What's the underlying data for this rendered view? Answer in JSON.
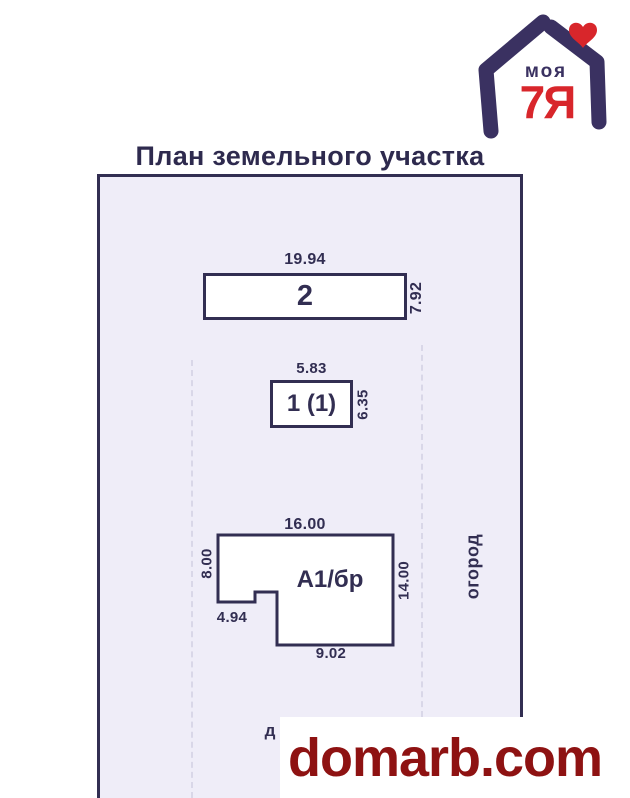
{
  "logo": {
    "top_text": "моя",
    "main_text": "7Я",
    "heart_icon": "heart"
  },
  "title": "План земельного участка",
  "buildings": {
    "b2": {
      "label": "2",
      "top_dim": "19.94",
      "side_dim": "7.92"
    },
    "b1": {
      "label": "1 (1)",
      "top_dim": "5.83",
      "side_dim": "6.35"
    },
    "a1": {
      "label": "А1/бр",
      "top_dim": "16.00",
      "left_dim": "8.00",
      "right_dim": "14.00",
      "notch_dim": "4.94",
      "bottom_dim": "9.02"
    }
  },
  "zones": {
    "garden": "огород",
    "road_partial": "д"
  },
  "watermark": {
    "text": "domarb.com"
  },
  "colors": {
    "ink": "#322e52",
    "plot_fill": "#efedf8",
    "logo_purple": "#3a3161",
    "logo_red": "#d8262b",
    "watermark_red": "#8e1212"
  }
}
